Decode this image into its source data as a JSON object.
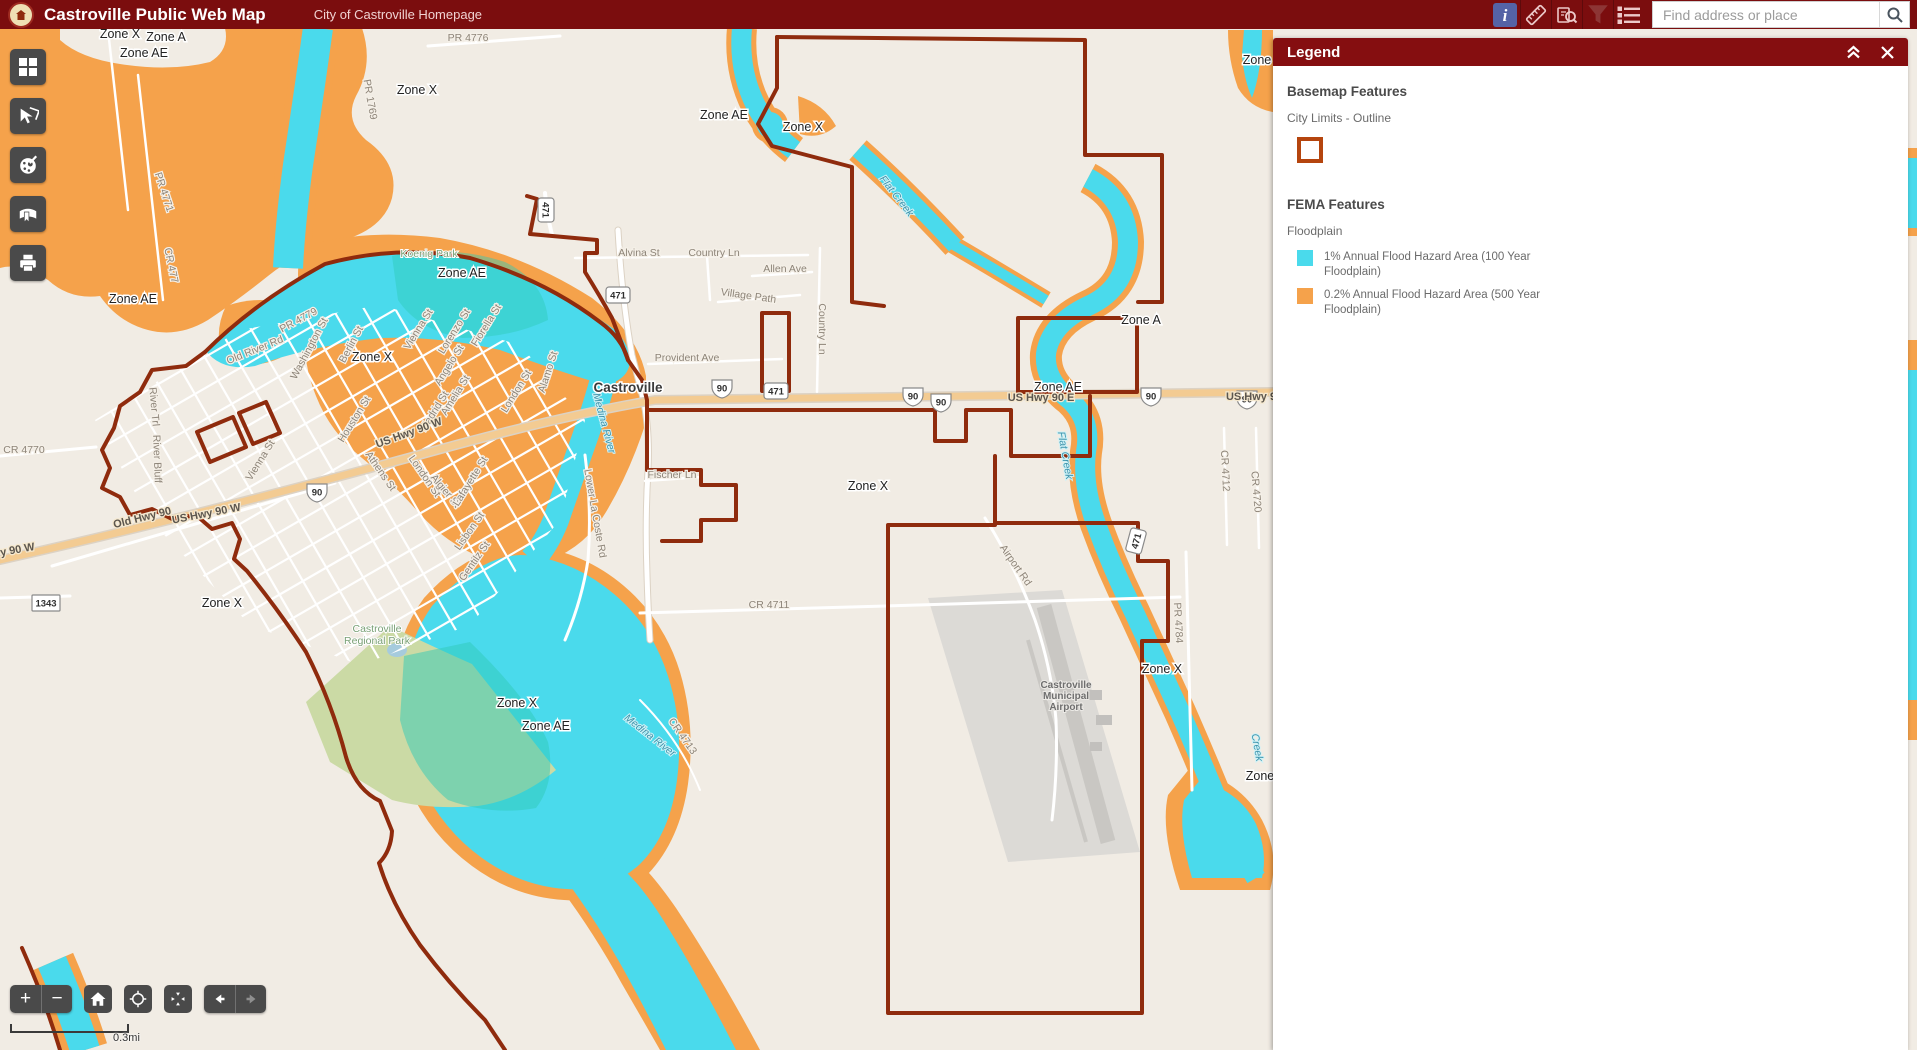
{
  "header": {
    "title": "Castroville Public Web Map",
    "homepage_link": "City of Castroville Homepage",
    "search_placeholder": "Find address or place",
    "icons": [
      "info-icon",
      "measure-icon",
      "query-icon",
      "filter-icon",
      "layer-list-icon",
      "search-icon"
    ]
  },
  "toolbar_icons": [
    "basemap-gallery-icon",
    "select-icon",
    "draw-icon",
    "bookmark-icon",
    "print-icon"
  ],
  "map_controls": {
    "zoom_in": "+",
    "zoom_out": "−",
    "icons": [
      "home-icon",
      "locate-icon",
      "extent-icon",
      "previous-extent-icon",
      "next-extent-icon"
    ]
  },
  "scalebar_label": "0.3mi",
  "legend": {
    "title": "Legend",
    "basemap_heading": "Basemap Features",
    "basemap_layer": "City Limits - Outline",
    "fema_heading": "FEMA Features",
    "fema_layer": "Floodplain",
    "swatch1_label": "1% Annual Flood Hazard Area (100 Year Floodplain)",
    "swatch2_label": "0.2% Annual Flood Hazard Area (500 Year Floodplain)"
  },
  "colors": {
    "header_bg": "#7B0D0E",
    "panel_header_bg": "#850E10",
    "flood_100yr_cyan": "#4ADAEC",
    "flood_500yr_orange": "#F5A24B",
    "city_limits_red": "#8F2B0D",
    "legend_outline_swatch": "#B5450E",
    "map_bg": "#F1ECE4",
    "toolbar_button": "#4A4A4A",
    "highway_fill": "#F3CB92",
    "info_icon_bg": "#5563A5"
  },
  "map": {
    "labels": [
      {
        "t": "Zone X",
        "x": 120,
        "y": 38,
        "c": "z"
      },
      {
        "t": "Zone A",
        "x": 166,
        "y": 41,
        "c": "z"
      },
      {
        "t": "Zone AE",
        "x": 144,
        "y": 57,
        "c": "z"
      },
      {
        "t": "Zone X",
        "x": 417,
        "y": 94,
        "c": "z"
      },
      {
        "t": "Zone AE",
        "x": 724,
        "y": 119,
        "c": "z"
      },
      {
        "t": "Zone X",
        "x": 803,
        "y": 131,
        "c": "z"
      },
      {
        "t": "Zone AE",
        "x": 462,
        "y": 277,
        "c": "z"
      },
      {
        "t": "Zone AE",
        "x": 133,
        "y": 303,
        "c": "z"
      },
      {
        "t": "Zone X",
        "x": 372,
        "y": 361,
        "c": "z"
      },
      {
        "t": "Zone A",
        "x": 1141,
        "y": 324,
        "c": "z"
      },
      {
        "t": "Zone AE",
        "x": 1058,
        "y": 391,
        "c": "z"
      },
      {
        "t": "Zone X",
        "x": 868,
        "y": 490,
        "c": "z"
      },
      {
        "t": "Zone X",
        "x": 222,
        "y": 607,
        "c": "z"
      },
      {
        "t": "Zone X",
        "x": 517,
        "y": 707,
        "c": "z"
      },
      {
        "t": "Zone AE",
        "x": 546,
        "y": 730,
        "c": "z"
      },
      {
        "t": "Zone X",
        "x": 1162,
        "y": 673,
        "c": "z"
      },
      {
        "t": "Zone",
        "x": 1257,
        "y": 64,
        "c": "z"
      },
      {
        "t": "Zone",
        "x": 1260,
        "y": 780,
        "c": "z"
      },
      {
        "t": "PR 4776",
        "x": 468,
        "y": 41,
        "c": "r"
      },
      {
        "t": "PR 1769",
        "x": 367,
        "y": 100,
        "r": 80,
        "c": "r"
      },
      {
        "t": "PR 4771",
        "x": 161,
        "y": 193,
        "r": 72,
        "c": "r"
      },
      {
        "t": "CR 477",
        "x": 168,
        "y": 266,
        "r": 78,
        "c": "r"
      },
      {
        "t": "Alvina St",
        "x": 639,
        "y": 256,
        "c": "r"
      },
      {
        "t": "Country Ln",
        "x": 714,
        "y": 256,
        "c": "r"
      },
      {
        "t": "Allen Ave",
        "x": 785,
        "y": 272,
        "c": "r"
      },
      {
        "t": "Village Path",
        "x": 748,
        "y": 299,
        "r": 8,
        "c": "r"
      },
      {
        "t": "Country Ln",
        "x": 819,
        "y": 329,
        "r": 90,
        "c": "r"
      },
      {
        "t": "Provident Ave",
        "x": 687,
        "y": 361,
        "c": "r"
      },
      {
        "t": "Old River Rd",
        "x": 256,
        "y": 353,
        "r": -22,
        "c": "r"
      },
      {
        "t": "PR 4779",
        "x": 300,
        "y": 323,
        "r": -28,
        "c": "r"
      },
      {
        "t": "Washington St",
        "x": 312,
        "y": 350,
        "r": -62,
        "c": "r"
      },
      {
        "t": "Berlin St",
        "x": 354,
        "y": 346,
        "r": -62,
        "c": "r"
      },
      {
        "t": "Vienna St",
        "x": 421,
        "y": 331,
        "r": -58,
        "c": "r"
      },
      {
        "t": "Lorenzo St",
        "x": 457,
        "y": 333,
        "r": -58,
        "c": "r"
      },
      {
        "t": "Fiorella St",
        "x": 489,
        "y": 327,
        "r": -58,
        "c": "r"
      },
      {
        "t": "Angelo St",
        "x": 452,
        "y": 367,
        "r": -58,
        "c": "r"
      },
      {
        "t": "Amelia St",
        "x": 458,
        "y": 397,
        "r": -58,
        "c": "r"
      },
      {
        "t": "Madrid St",
        "x": 437,
        "y": 413,
        "r": -58,
        "c": "r"
      },
      {
        "t": "Houston St",
        "x": 357,
        "y": 421,
        "r": -58,
        "c": "r"
      },
      {
        "t": "Alamo St",
        "x": 551,
        "y": 373,
        "r": -72,
        "c": "r"
      },
      {
        "t": "London St",
        "x": 519,
        "y": 393,
        "r": -58,
        "c": "r"
      },
      {
        "t": "Vienna St",
        "x": 263,
        "y": 462,
        "r": -58,
        "c": "r"
      },
      {
        "t": "Athens St",
        "x": 378,
        "y": 473,
        "r": 55,
        "c": "r"
      },
      {
        "t": "London St",
        "x": 422,
        "y": 478,
        "r": 55,
        "c": "r"
      },
      {
        "t": "Algier St",
        "x": 443,
        "y": 493,
        "r": 50,
        "c": "r"
      },
      {
        "t": "Lafayette St",
        "x": 473,
        "y": 483,
        "r": -58,
        "c": "r"
      },
      {
        "t": "Lisbon St",
        "x": 472,
        "y": 533,
        "r": -55,
        "c": "r"
      },
      {
        "t": "Gentilz St",
        "x": 477,
        "y": 563,
        "r": -55,
        "c": "r"
      },
      {
        "t": "Lower La Coste Rd",
        "x": 592,
        "y": 514,
        "r": 80,
        "c": "r"
      },
      {
        "t": "Fischer Ln",
        "x": 672,
        "y": 478,
        "c": "r"
      },
      {
        "t": "US Hwy 90 W",
        "x": 410,
        "y": 436,
        "r": -20,
        "c": "h"
      },
      {
        "t": "US Hwy 90 W",
        "x": 207,
        "y": 517,
        "r": -11,
        "c": "h"
      },
      {
        "t": "Old Hwy 90",
        "x": 143,
        "y": 521,
        "r": -14,
        "c": "h"
      },
      {
        "t": "y 90 W",
        "x": 18,
        "y": 553,
        "r": -10,
        "c": "h"
      },
      {
        "t": "US Hwy 90 E",
        "x": 1041,
        "y": 401,
        "c": "h"
      },
      {
        "t": "US Hwy 9",
        "x": 1251,
        "y": 400,
        "c": "h"
      },
      {
        "t": "CR 4770",
        "x": 24,
        "y": 453,
        "c": "r"
      },
      {
        "t": "River Trl",
        "x": 151,
        "y": 407,
        "r": 85,
        "c": "r"
      },
      {
        "t": "River Bluff",
        "x": 154,
        "y": 459,
        "r": 88,
        "c": "r"
      },
      {
        "t": "CR 4711",
        "x": 769,
        "y": 608,
        "c": "r"
      },
      {
        "t": "Airport Rd",
        "x": 1013,
        "y": 567,
        "r": 55,
        "c": "r"
      },
      {
        "t": "CR 4712",
        "x": 1222,
        "y": 471,
        "r": 87,
        "c": "r"
      },
      {
        "t": "CR 4720",
        "x": 1253,
        "y": 492,
        "r": 85,
        "c": "r"
      },
      {
        "t": "PR 4784",
        "x": 1175,
        "y": 623,
        "r": 87,
        "c": "r"
      },
      {
        "t": "CR 4713",
        "x": 680,
        "y": 738,
        "r": 55,
        "c": "r"
      },
      {
        "t": "Flat Creek",
        "x": 894,
        "y": 198,
        "r": 52,
        "c": "w"
      },
      {
        "t": "Flat Creek",
        "x": 1062,
        "y": 456,
        "r": 80,
        "c": "w"
      },
      {
        "t": "Medina River",
        "x": 601,
        "y": 424,
        "r": 75,
        "c": "w"
      },
      {
        "t": "Medina River",
        "x": 648,
        "y": 738,
        "r": 38,
        "c": "w"
      },
      {
        "t": "Creek",
        "x": 1254,
        "y": 748,
        "r": 80,
        "c": "w"
      },
      {
        "t": "Koenig Park",
        "x": 429,
        "y": 257,
        "c": "p"
      },
      {
        "t": "Castroville",
        "x": 377,
        "y": 632,
        "c": "p"
      },
      {
        "t": "Regional Park",
        "x": 377,
        "y": 644,
        "c": "p"
      },
      {
        "t": "Castroville",
        "x": 628,
        "y": 392,
        "c": "c"
      },
      {
        "t": "Castroville",
        "x": 1066,
        "y": 688,
        "c": "a"
      },
      {
        "t": "Municipal",
        "x": 1066,
        "y": 699,
        "c": "a"
      },
      {
        "t": "Airport",
        "x": 1066,
        "y": 710,
        "c": "a"
      }
    ],
    "shields": [
      {
        "type": "us",
        "t": "90",
        "x": 722,
        "y": 388
      },
      {
        "type": "us",
        "t": "90",
        "x": 913,
        "y": 396
      },
      {
        "type": "us",
        "t": "90",
        "x": 941,
        "y": 402
      },
      {
        "type": "us",
        "t": "90",
        "x": 1151,
        "y": 396
      },
      {
        "type": "us",
        "t": "90",
        "x": 317,
        "y": 492
      },
      {
        "type": "us",
        "t": "90",
        "x": 1247,
        "y": 399
      },
      {
        "type": "r471",
        "t": "471",
        "x": 618,
        "y": 295
      },
      {
        "type": "r471",
        "t": "471",
        "x": 776,
        "y": 391
      },
      {
        "type": "r471",
        "t": "471",
        "x": 546,
        "y": 210,
        "r": 90
      },
      {
        "type": "r471",
        "t": "471",
        "x": 1136,
        "y": 541,
        "r": -75
      },
      {
        "type": "box",
        "t": "1343",
        "x": 46,
        "y": 603
      }
    ]
  }
}
